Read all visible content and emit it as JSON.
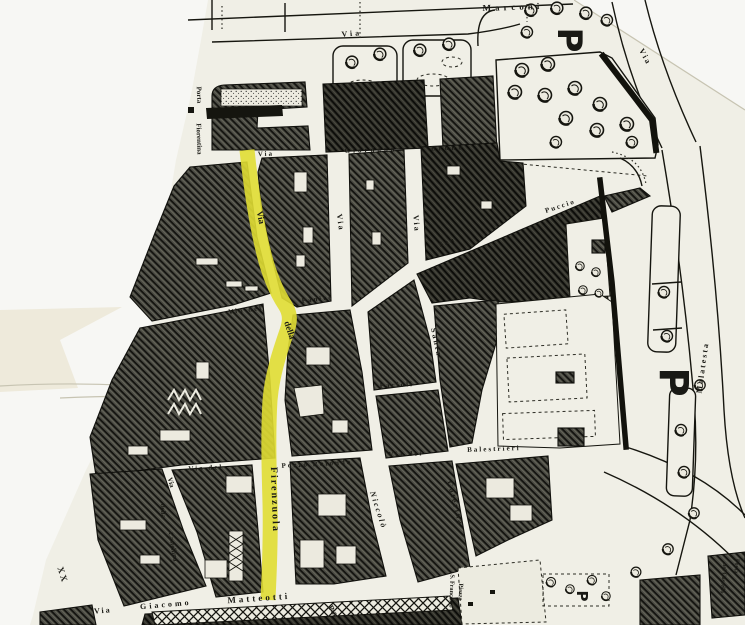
{
  "map": {
    "highlighted_street": "Via della Firenzuola",
    "colors": {
      "paper": "#f0efe6",
      "margin": "#f7f7f4",
      "ink": "#1b1b16",
      "highlight": "#e0dd33",
      "tape": "#eeeadb",
      "crease": "#c7c4b2"
    },
    "labels": {
      "marconi": "Marconi",
      "via_top": "Via",
      "via_topright": "Via",
      "via_giordano": "Via",
      "giordano": "Giordano",
      "bruno": "Bruno",
      "porta": "Porta",
      "fiorentina": "Fiorentina",
      "via_v1": "Via",
      "via_v2": "Via",
      "san": "San",
      "puccio": "Puccio",
      "via_yellow": "Via",
      "della_yellow": "della",
      "firenzuola": "Firenzuola",
      "via_del_panico": "Via del",
      "panico": "Pànico",
      "santa": "Santa",
      "caterina": "Caterina",
      "niccolo": "Niccolò",
      "pacioli": "Pacioli",
      "via_dei": "Via dei",
      "balestrieri": "Balestrieri",
      "via_del_pozzo": "Via del",
      "pozzo_rotondo": "Pozzo Rotondo",
      "castellina_via": "Via",
      "castellina_della": "della",
      "castellina_name": "Castellina",
      "xx": "XX",
      "via_matteotti": "Via",
      "giacomo": "Giacomo",
      "matteotti": "Matteotti",
      "malatesta": "Malatesta",
      "porta_castello_a": "Porta",
      "porta_castello_b": "del Castello",
      "piazza": "Piazza",
      "s_francesco": "S. Francesco",
      "pia": "Pia",
      "p": "P"
    }
  }
}
